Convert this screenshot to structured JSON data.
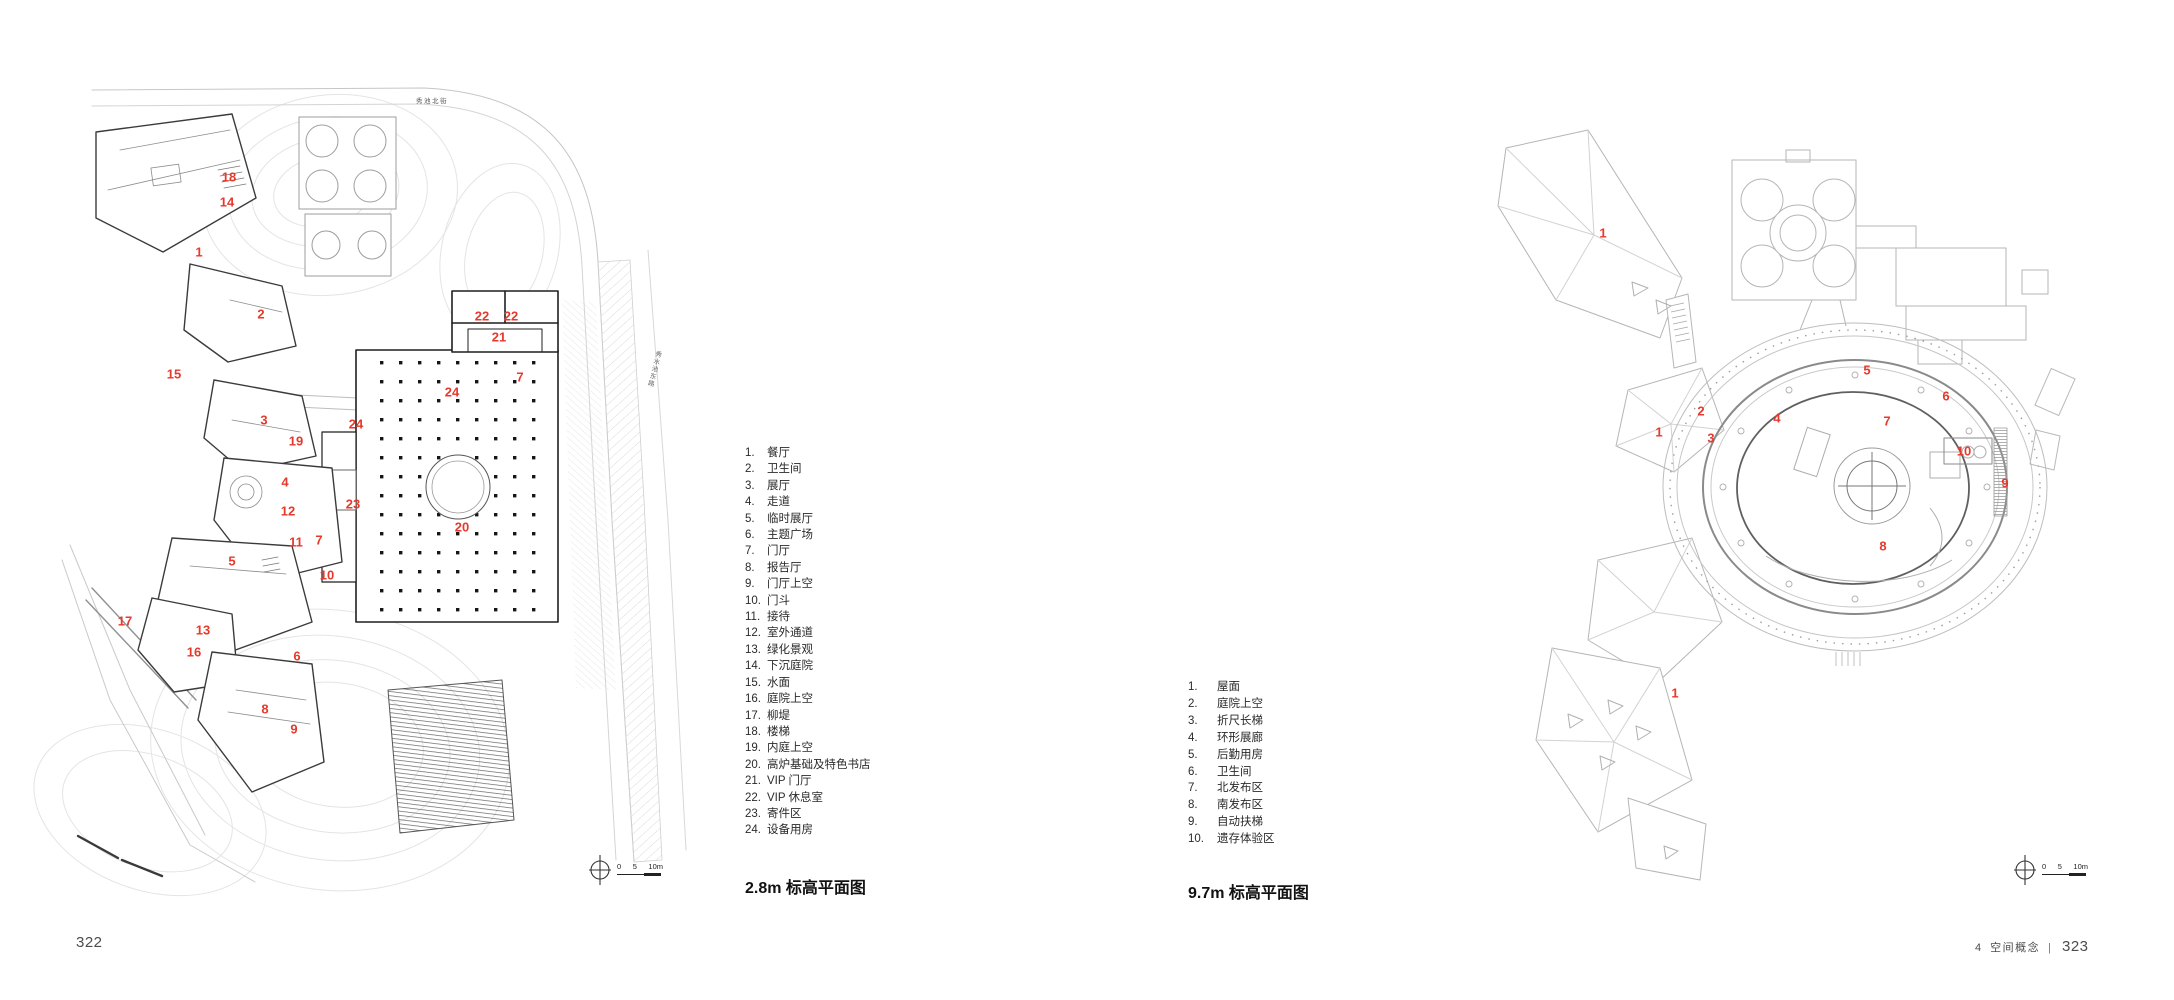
{
  "colors": {
    "marker_red": "#e6392c",
    "ink": "#2a2a2a",
    "line_light": "#c9c9c9",
    "footer_gray": "#4c4c4c"
  },
  "footer": {
    "left_page_number": "322",
    "chapter_number": "4",
    "chapter_title": "空间概念",
    "divider": "|",
    "right_page_number": "323"
  },
  "left_plan": {
    "caption": "2.8m 标高平面图",
    "road_label_top": "秀池北街",
    "road_label_right": "秀水池东路",
    "scale_bar": {
      "t0": "0",
      "t5": "5",
      "t10": "10m"
    },
    "legend": [
      {
        "num": "1.",
        "label": "餐厅"
      },
      {
        "num": "2.",
        "label": "卫生间"
      },
      {
        "num": "3.",
        "label": "展厅"
      },
      {
        "num": "4.",
        "label": "走道"
      },
      {
        "num": "5.",
        "label": "临时展厅"
      },
      {
        "num": "6.",
        "label": "主题广场"
      },
      {
        "num": "7.",
        "label": "门厅"
      },
      {
        "num": "8.",
        "label": "报告厅"
      },
      {
        "num": "9.",
        "label": "门厅上空"
      },
      {
        "num": "10.",
        "label": "门斗"
      },
      {
        "num": "11.",
        "label": "接待"
      },
      {
        "num": "12.",
        "label": "室外通道"
      },
      {
        "num": "13.",
        "label": "绿化景观"
      },
      {
        "num": "14.",
        "label": "下沉庭院"
      },
      {
        "num": "15.",
        "label": "水面"
      },
      {
        "num": "16.",
        "label": "庭院上空"
      },
      {
        "num": "17.",
        "label": "柳堤"
      },
      {
        "num": "18.",
        "label": "楼梯"
      },
      {
        "num": "19.",
        "label": "内庭上空"
      },
      {
        "num": "20.",
        "label": "高炉基础及特色书店"
      },
      {
        "num": "21.",
        "label": "VIP 门厅"
      },
      {
        "num": "22.",
        "label": "VIP 休息室"
      },
      {
        "num": "23.",
        "label": "寄件区"
      },
      {
        "num": "24.",
        "label": "设备用房"
      }
    ],
    "markers": [
      {
        "n": "18",
        "x": 229,
        "y": 177
      },
      {
        "n": "14",
        "x": 227,
        "y": 202
      },
      {
        "n": "1",
        "x": 199,
        "y": 252
      },
      {
        "n": "2",
        "x": 261,
        "y": 314
      },
      {
        "n": "15",
        "x": 174,
        "y": 374
      },
      {
        "n": "3",
        "x": 264,
        "y": 420
      },
      {
        "n": "19",
        "x": 296,
        "y": 441
      },
      {
        "n": "24",
        "x": 356,
        "y": 424
      },
      {
        "n": "22",
        "x": 482,
        "y": 316
      },
      {
        "n": "22",
        "x": 511,
        "y": 316
      },
      {
        "n": "21",
        "x": 499,
        "y": 337
      },
      {
        "n": "7",
        "x": 520,
        "y": 377
      },
      {
        "n": "24",
        "x": 452,
        "y": 392
      },
      {
        "n": "20",
        "x": 462,
        "y": 527
      },
      {
        "n": "23",
        "x": 353,
        "y": 504
      },
      {
        "n": "4",
        "x": 285,
        "y": 482
      },
      {
        "n": "12",
        "x": 288,
        "y": 511
      },
      {
        "n": "11",
        "x": 296,
        "y": 542
      },
      {
        "n": "7",
        "x": 319,
        "y": 540
      },
      {
        "n": "5",
        "x": 232,
        "y": 561
      },
      {
        "n": "10",
        "x": 327,
        "y": 575
      },
      {
        "n": "17",
        "x": 125,
        "y": 621
      },
      {
        "n": "13",
        "x": 203,
        "y": 630
      },
      {
        "n": "16",
        "x": 194,
        "y": 652
      },
      {
        "n": "6",
        "x": 297,
        "y": 656
      },
      {
        "n": "8",
        "x": 265,
        "y": 709
      },
      {
        "n": "9",
        "x": 294,
        "y": 729
      }
    ]
  },
  "right_plan": {
    "caption": "9.7m 标高平面图",
    "scale_bar": {
      "t0": "0",
      "t5": "5",
      "t10": "10m"
    },
    "legend": [
      {
        "num": "1.",
        "label": "屋面"
      },
      {
        "num": "2.",
        "label": "庭院上空"
      },
      {
        "num": "3.",
        "label": "折尺长梯"
      },
      {
        "num": "4.",
        "label": "环形展廊"
      },
      {
        "num": "5.",
        "label": "后勤用房"
      },
      {
        "num": "6.",
        "label": "卫生间"
      },
      {
        "num": "7.",
        "label": "北发布区"
      },
      {
        "num": "8.",
        "label": "南发布区"
      },
      {
        "num": "9.",
        "label": "自动扶梯"
      },
      {
        "num": "10.",
        "label": "遗存体验区"
      }
    ],
    "markers": [
      {
        "n": "1",
        "x": 1603,
        "y": 233
      },
      {
        "n": "2",
        "x": 1701,
        "y": 411
      },
      {
        "n": "1",
        "x": 1659,
        "y": 432
      },
      {
        "n": "3",
        "x": 1711,
        "y": 438
      },
      {
        "n": "4",
        "x": 1777,
        "y": 418
      },
      {
        "n": "5",
        "x": 1867,
        "y": 370
      },
      {
        "n": "6",
        "x": 1946,
        "y": 396
      },
      {
        "n": "7",
        "x": 1887,
        "y": 421
      },
      {
        "n": "10",
        "x": 1964,
        "y": 451
      },
      {
        "n": "9",
        "x": 2005,
        "y": 483
      },
      {
        "n": "8",
        "x": 1883,
        "y": 546
      },
      {
        "n": "1",
        "x": 1675,
        "y": 693
      }
    ]
  }
}
